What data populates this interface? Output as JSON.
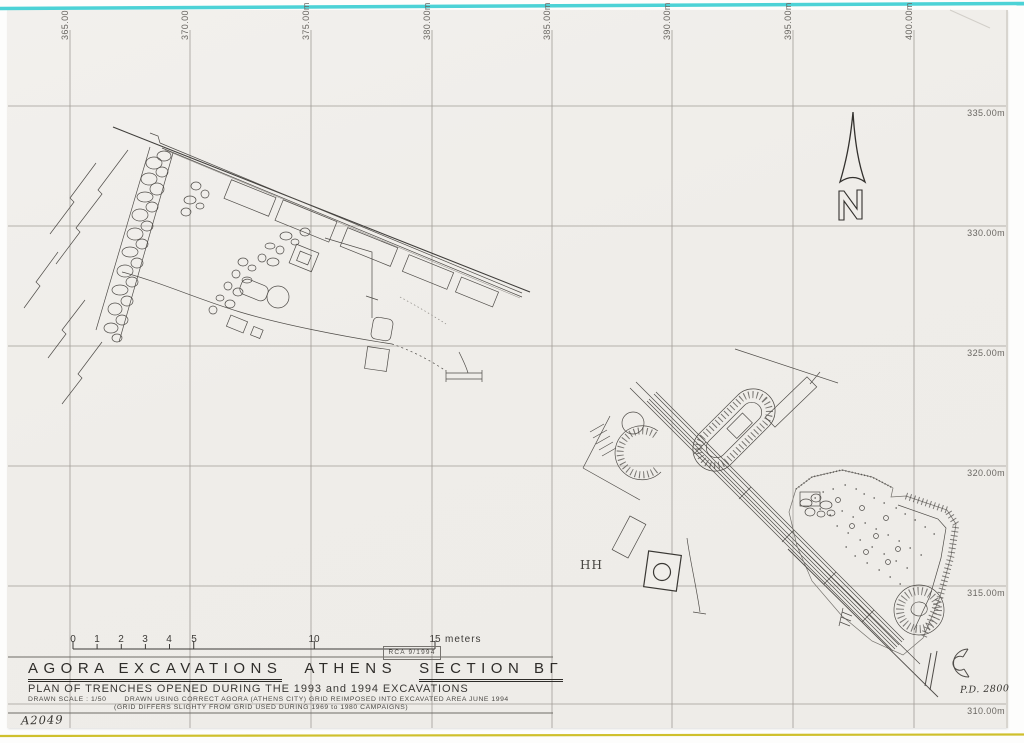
{
  "drawing": {
    "title": {
      "part1": "AGORA EXCAVATIONS",
      "part2": "ATHENS",
      "part3": "SECTION BΓ"
    },
    "subtitle": "PLAN OF TRENCHES OPENED DURING THE 1993 and 1994 EXCAVATIONS",
    "notes": {
      "scale": "DRAWN SCALE : 1/50",
      "line1": "DRAWN USING CORRECT AGORA (ATHENS CITY) GRID REIMPOSED INTO EXCAVATED AREA JUNE 1994",
      "line2": "(GRID DIFFERS SLIGHTY FROM GRID USED DURING 1969 to 1980 CAMPAIGNS)"
    },
    "credit_stamp": "RCA 9/1994",
    "inventory_number": "A2049",
    "plate_number": "P.D. 2800",
    "area_label": "HH",
    "north_label": "N"
  },
  "grid": {
    "x_labels": [
      "365.00",
      "370.00",
      "375.00m",
      "380.00m",
      "385.00m",
      "390.00m",
      "395.00m",
      "400.00m"
    ],
    "y_labels": [
      "335.00m",
      "330.00m",
      "325.00m",
      "320.00m",
      "315.00m",
      "310.00m"
    ]
  },
  "scale_bar": {
    "labels": [
      "0",
      "1",
      "2",
      "3",
      "4",
      "5",
      "10",
      "15"
    ],
    "unit": "meters"
  },
  "colors": {
    "paper": "#f0eeea",
    "top_edge_line": "#4cd2d6",
    "bottom_edge_line": "#cfc02c",
    "ink": "#4a4844"
  }
}
